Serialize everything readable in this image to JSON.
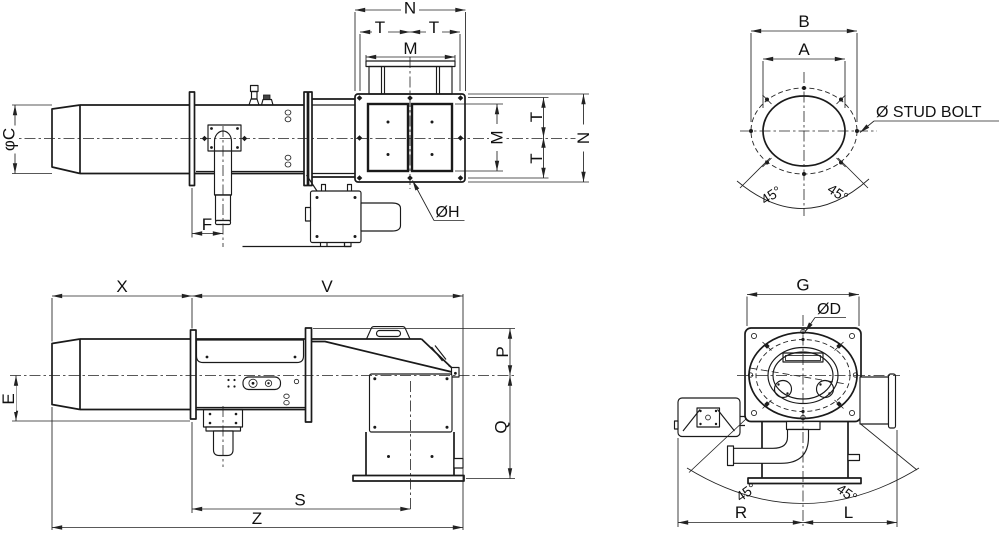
{
  "colors": {
    "background": "#ffffff",
    "line": "#1a1a1a",
    "dim": "#222222",
    "text": "#111111"
  },
  "v1": {
    "n_top": "N",
    "t_top_left": "T",
    "t_top_right": "T",
    "m_top": "M",
    "phi_c": "φC",
    "f": "F",
    "dia_h": "ØH",
    "m_right": "M",
    "t_right_upper": "T",
    "t_right_lower": "T",
    "n_right": "N"
  },
  "v2": {
    "b": "B",
    "a": "A",
    "stud_bolt": "Ø STUD BOLT",
    "angle_left": "45°",
    "angle_right": "45°"
  },
  "v3": {
    "x": "X",
    "v": "V",
    "e": "E",
    "p": "P",
    "q": "Q",
    "s": "S",
    "z": "Z"
  },
  "v4": {
    "g": "G",
    "dia_d": "ØD",
    "angle_left": "45°",
    "angle_right": "45°",
    "r": "R",
    "l": "L"
  }
}
